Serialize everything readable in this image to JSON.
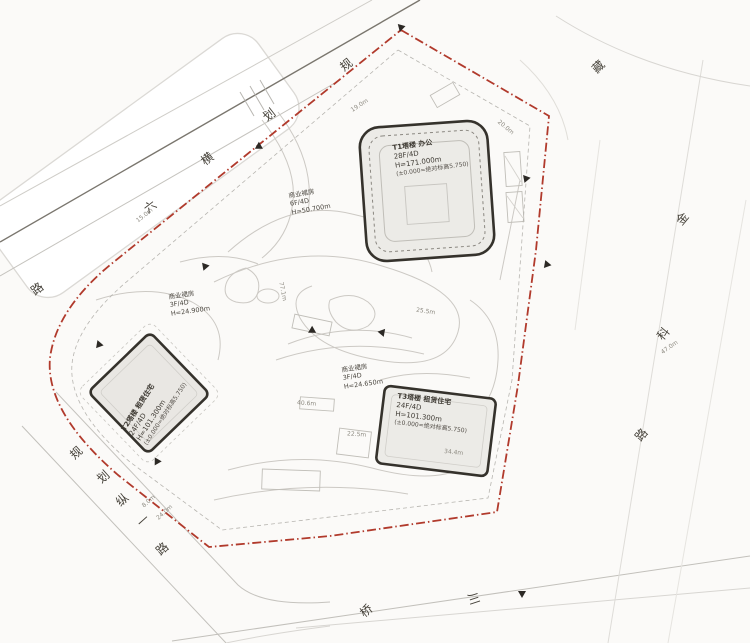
{
  "drawing": {
    "kind": "site-master-plan",
    "colors": {
      "site_boundary": "#b13a2c",
      "building_outline": "#35322c",
      "building_fill": "#ecebe7",
      "linework": "#c5c3be",
      "text": "#46423a"
    }
  },
  "roads": [
    {
      "name": "规划横六路",
      "chars": [
        {
          "c": "规",
          "x": 340,
          "y": 56,
          "r": -38
        },
        {
          "c": "划",
          "x": 263,
          "y": 106,
          "r": -38
        },
        {
          "c": "横",
          "x": 201,
          "y": 150,
          "r": -38
        },
        {
          "c": "六",
          "x": 144,
          "y": 198,
          "r": -38
        },
        {
          "c": "路",
          "x": 31,
          "y": 280,
          "r": -38
        }
      ]
    },
    {
      "name": "规划纵一路",
      "chars": [
        {
          "c": "规",
          "x": 70,
          "y": 444,
          "r": -42
        },
        {
          "c": "划",
          "x": 97,
          "y": 468,
          "r": -42
        },
        {
          "c": "纵",
          "x": 116,
          "y": 491,
          "r": -42
        },
        {
          "c": "一",
          "x": 137,
          "y": 512,
          "r": -42
        },
        {
          "c": "路",
          "x": 156,
          "y": 540,
          "r": -42
        }
      ]
    },
    {
      "name": "金科路",
      "chars": [
        {
          "c": "金",
          "x": 676,
          "y": 210,
          "r": -50
        },
        {
          "c": "科",
          "x": 657,
          "y": 325,
          "r": -50
        },
        {
          "c": "路",
          "x": 635,
          "y": 426,
          "r": -50
        }
      ]
    },
    {
      "name": "金藏路",
      "chars": [
        {
          "c": "藏",
          "x": 592,
          "y": 58,
          "r": -45
        }
      ]
    },
    {
      "name": "川桥路",
      "chars": [
        {
          "c": "桥",
          "x": 360,
          "y": 602,
          "r": -40
        },
        {
          "c": "川",
          "x": 468,
          "y": 590,
          "r": 72
        }
      ]
    }
  ],
  "buildings": [
    {
      "id": "T1",
      "lines": [
        "T1塔楼 办公",
        "28F/4D",
        "H=171.000m",
        "(±0.000=绝对标高5.750)"
      ]
    },
    {
      "id": "T2",
      "lines": [
        "T2塔楼 租赁住宅",
        "24F/4D",
        "H=101.300m",
        "(±0.000=绝对标高5.750)"
      ]
    },
    {
      "id": "T3",
      "lines": [
        "T3塔楼 租赁住宅",
        "24F/4D",
        "H=101.300m",
        "(±0.000=绝对标高5.750)"
      ]
    }
  ],
  "podiums": [
    {
      "lines": [
        "商业裙房",
        "6F/4D",
        "H=50.700m"
      ]
    },
    {
      "lines": [
        "商业裙房",
        "3F/4D",
        "H=24.900m"
      ]
    },
    {
      "lines": [
        "商业裙房",
        "3F/4D",
        "H=24.650m"
      ]
    }
  ],
  "dimensions": [
    {
      "t": "15.0m",
      "x": 135,
      "y": 212,
      "r": -38
    },
    {
      "t": "19.0m",
      "x": 350,
      "y": 102,
      "r": -33
    },
    {
      "t": "20.0m",
      "x": 496,
      "y": 124,
      "r": 40
    },
    {
      "t": "8.0m",
      "x": 141,
      "y": 498,
      "r": -42
    },
    {
      "t": "24.0m",
      "x": 155,
      "y": 509,
      "r": -42
    },
    {
      "t": "47.0m",
      "x": 660,
      "y": 344,
      "r": -35
    },
    {
      "t": "77.1m",
      "x": 273,
      "y": 288,
      "r": 78
    },
    {
      "t": "25.5m",
      "x": 416,
      "y": 308,
      "r": 8
    },
    {
      "t": "40.6m",
      "x": 297,
      "y": 400,
      "r": 4
    },
    {
      "t": "22.5m",
      "x": 347,
      "y": 431,
      "r": 4
    },
    {
      "t": "34.4m",
      "x": 444,
      "y": 449,
      "r": 6
    }
  ],
  "markers": [
    {
      "x": 397,
      "y": 25,
      "r": 15
    },
    {
      "x": 255,
      "y": 144,
      "r": -60
    },
    {
      "x": 201,
      "y": 264,
      "r": 20
    },
    {
      "x": 95,
      "y": 342,
      "r": 160
    },
    {
      "x": 153,
      "y": 459,
      "r": 30
    },
    {
      "x": 518,
      "y": 591,
      "r": 0
    },
    {
      "x": 543,
      "y": 262,
      "r": -80
    },
    {
      "x": 522,
      "y": 176,
      "r": 140
    },
    {
      "x": 378,
      "y": 330,
      "r": 100
    },
    {
      "x": 308,
      "y": 328,
      "r": 60
    }
  ]
}
